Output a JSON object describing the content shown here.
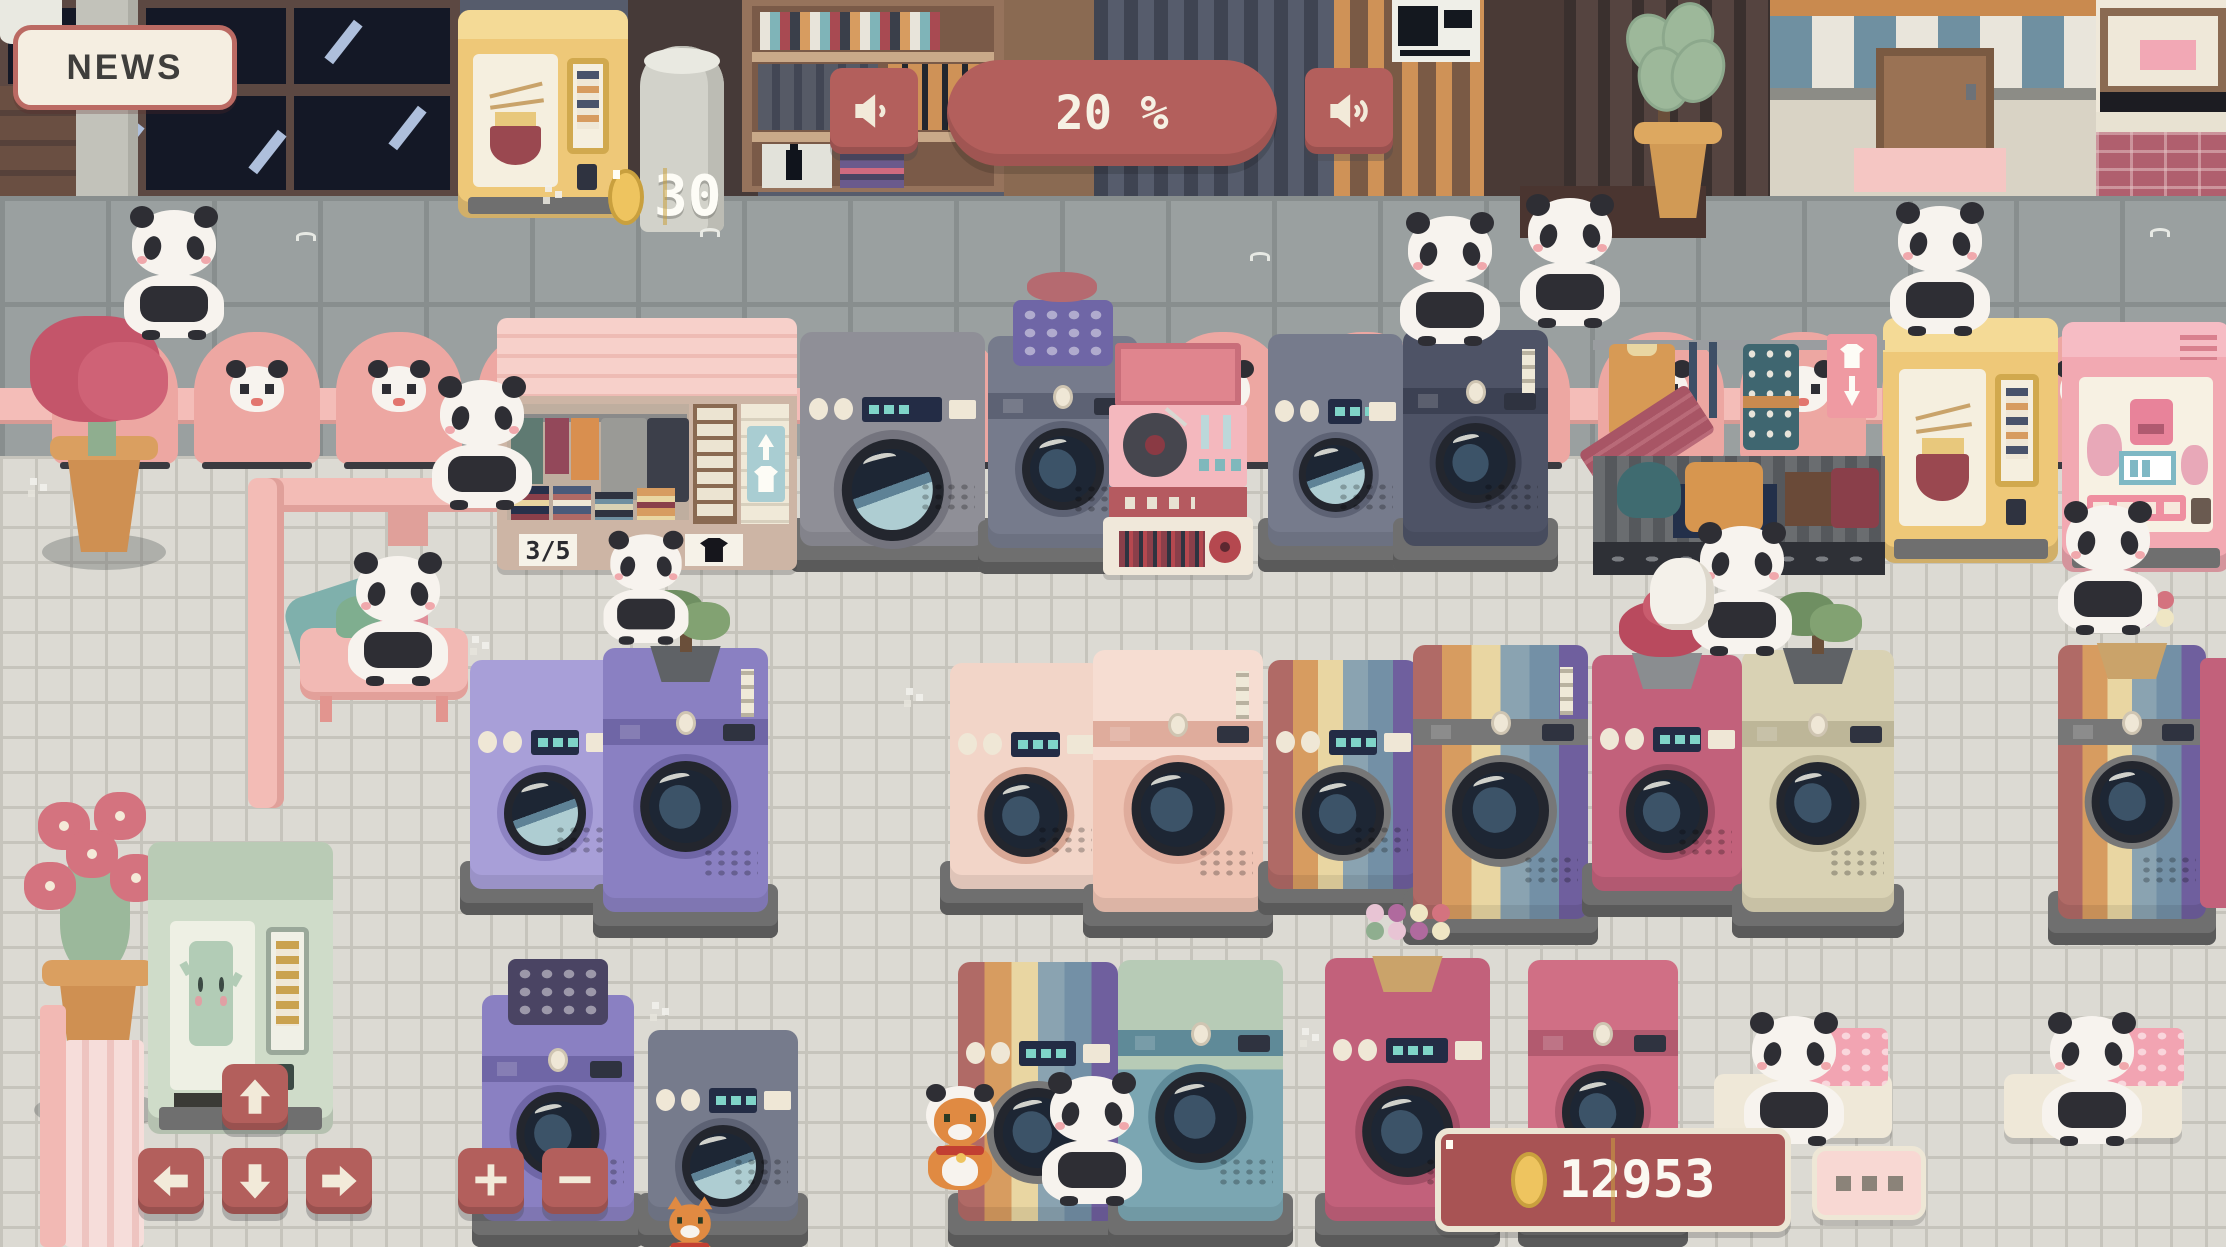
{
  "hud": {
    "news_label": "NEWS",
    "music_volume": "20 %",
    "ramen_stock": "30",
    "stall_capacity": "3/5",
    "coin_balance": "12953"
  },
  "controls": {
    "zoom_in_label": "+",
    "zoom_out_label": "−",
    "pan_up_icon": "arrow-up-icon",
    "pan_down_icon": "arrow-down-icon",
    "pan_left_icon": "arrow-left-icon",
    "pan_right_icon": "arrow-right-icon",
    "volume_left_icon": "speaker-low-icon",
    "volume_right_icon": "speaker-high-icon",
    "more_menu_icon": "ellipsis-icon",
    "coin_icon": "coin-icon",
    "stall_tag_icon": "shirt-icon"
  },
  "colors": {
    "accent_red": "#b35f5c",
    "cream": "#f2ead9",
    "panel_cream": "#f5eee1",
    "text_dark": "#3f3e3c",
    "maroon_panel": "#a85354",
    "pink_button": "#f8d8d3",
    "dot_grey": "#8b8379",
    "coin_gold": "#eec45f",
    "coin_gold_dark": "#c9a03e",
    "pink_chair": "#eda7a2",
    "pink_rail": "#f4bdb8",
    "pavement": "#9aa0a0",
    "pavement_line": "#888e8e",
    "floor": "#dcdad3",
    "floor_line": "#c6c4bc",
    "panda_white": "#f7f3ee",
    "panda_black": "#2e2e34"
  },
  "palettes": {
    "grey": {
      "body": "#8f8f97",
      "accent": "#74747e"
    },
    "slate": {
      "body": "#767b8c",
      "accent": "#5d6274"
    },
    "navy": {
      "body": "#4e5366",
      "accent": "#3c4153"
    },
    "lavender": {
      "body": "#a89fd8",
      "accent": "#8d83c2"
    },
    "purple": {
      "body": "#8a80c2",
      "accent": "#6f66a6"
    },
    "blush": {
      "body": "#f2d5c8",
      "accent": "#d8a896"
    },
    "palepink": {
      "top": "#f6ddd2",
      "body": "#efc4b4",
      "accent": "#dfac9c"
    },
    "rose": {
      "body": "#c2617b",
      "accent": "#a34e66"
    },
    "rose2": {
      "body": "#d06f85",
      "accent": "#b25a6f"
    },
    "sand": {
      "body": "#d9d2b4",
      "accent": "#bdb698"
    },
    "teal": {
      "top": "#b7cbb6",
      "body": "#7ba6b2",
      "accent": "#5f8a98"
    },
    "rainbow": {
      "stripes": [
        "#b06a66",
        "#d79c60",
        "#e9d6a2",
        "#8aa3b1",
        "#7390a6",
        "#6f5f9e"
      ]
    }
  },
  "scene": {
    "chairs": [
      {
        "x": 52,
        "y": 332
      },
      {
        "x": 194,
        "y": 332
      },
      {
        "x": 336,
        "y": 332
      },
      {
        "x": 478,
        "y": 332
      },
      {
        "x": 620,
        "y": 332
      },
      {
        "x": 876,
        "y": 332
      },
      {
        "x": 1018,
        "y": 332
      },
      {
        "x": 1160,
        "y": 332
      },
      {
        "x": 1302,
        "y": 332
      },
      {
        "x": 1444,
        "y": 332
      },
      {
        "x": 1598,
        "y": 332
      },
      {
        "x": 1740,
        "y": 332
      },
      {
        "x": 1882,
        "y": 332
      },
      {
        "x": 2024,
        "y": 332
      },
      {
        "x": 2166,
        "y": 332
      }
    ],
    "machines": [
      {
        "x": 800,
        "y": 332,
        "w": 185,
        "h": 240,
        "p": "grey",
        "t": "front",
        "water": true,
        "z": 12
      },
      {
        "x": 988,
        "y": 336,
        "w": 150,
        "h": 238,
        "p": "slate",
        "t": "top",
        "decor": "basket-purple",
        "z": 12
      },
      {
        "x": 1268,
        "y": 334,
        "w": 135,
        "h": 238,
        "p": "slate",
        "t": "front",
        "water": true,
        "z": 12
      },
      {
        "x": 1403,
        "y": 330,
        "w": 145,
        "h": 242,
        "p": "navy",
        "t": "top",
        "note": true,
        "z": 12
      },
      {
        "x": 470,
        "y": 660,
        "w": 150,
        "h": 255,
        "p": "lavender",
        "t": "front",
        "water": true,
        "z": 20
      },
      {
        "x": 603,
        "y": 648,
        "w": 165,
        "h": 290,
        "p": "purple",
        "t": "top",
        "decor": "bonsai",
        "note": true,
        "z": 20
      },
      {
        "x": 950,
        "y": 663,
        "w": 152,
        "h": 252,
        "p": "blush",
        "t": "front",
        "z": 20
      },
      {
        "x": 1093,
        "y": 650,
        "w": 170,
        "h": 288,
        "p": "palepink",
        "t": "top",
        "note": true,
        "z": 20
      },
      {
        "x": 1268,
        "y": 660,
        "w": 150,
        "h": 255,
        "p": "rainbow",
        "t": "front",
        "z": 20
      },
      {
        "x": 1413,
        "y": 645,
        "w": 175,
        "h": 300,
        "p": "rainbow",
        "t": "top",
        "note": true,
        "z": 20
      },
      {
        "x": 1592,
        "y": 655,
        "w": 150,
        "h": 262,
        "p": "rose",
        "t": "front",
        "decor": "flowers-red",
        "z": 20
      },
      {
        "x": 1742,
        "y": 650,
        "w": 152,
        "h": 288,
        "p": "sand",
        "t": "top",
        "decor": "bonsai",
        "z": 20
      },
      {
        "x": 2058,
        "y": 645,
        "w": 148,
        "h": 300,
        "p": "rainbow",
        "t": "top",
        "decor": "flowers-basket",
        "z": 20
      },
      {
        "x": 482,
        "y": 995,
        "w": 152,
        "h": 252,
        "p": "purple",
        "t": "top",
        "decor": "basket-dots",
        "z": 34
      },
      {
        "x": 648,
        "y": 1030,
        "w": 150,
        "h": 217,
        "p": "slate",
        "t": "front",
        "water": true,
        "z": 34
      },
      {
        "x": 958,
        "y": 962,
        "w": 160,
        "h": 285,
        "p": "rainbow",
        "t": "front",
        "z": 34
      },
      {
        "x": 1118,
        "y": 960,
        "w": 165,
        "h": 287,
        "p": "teal",
        "t": "top",
        "z": 34
      },
      {
        "x": 1325,
        "y": 958,
        "w": 165,
        "h": 289,
        "p": "rose",
        "t": "front",
        "decor": "flowers-basket",
        "z": 34
      },
      {
        "x": 1528,
        "y": 960,
        "w": 150,
        "h": 287,
        "p": "rose2",
        "t": "top",
        "z": 34
      }
    ],
    "pandas": [
      {
        "x": 118,
        "y": 210
      },
      {
        "x": 1394,
        "y": 216,
        "flip": true
      },
      {
        "x": 1514,
        "y": 198
      },
      {
        "x": 1884,
        "y": 206,
        "flip": true
      },
      {
        "x": 426,
        "y": 380
      },
      {
        "x": 590,
        "y": 515,
        "s": 0.85
      },
      {
        "x": 342,
        "y": 556
      },
      {
        "x": 1686,
        "y": 526
      },
      {
        "x": 2052,
        "y": 505,
        "flip": true
      },
      {
        "x": 1036,
        "y": 1076
      },
      {
        "x": 1738,
        "y": 1016
      },
      {
        "x": 2036,
        "y": 1016,
        "flip": true
      }
    ],
    "cats": [
      {
        "x": 918,
        "y": 1086,
        "hood": true
      },
      {
        "x": 648,
        "y": 1174,
        "s": 0.8
      }
    ],
    "plants": [
      {
        "t": "redleaf",
        "x": 26,
        "y": 316
      },
      {
        "t": "pinkflower",
        "x": 20,
        "y": 792
      },
      {
        "t": "ficus",
        "x": 1628,
        "y": 2
      }
    ],
    "vendings": [
      {
        "t": "ramen",
        "x": 458,
        "y": 10,
        "w": 170,
        "h": 208,
        "z": 3
      },
      {
        "t": "ramen",
        "x": 1883,
        "y": 318,
        "w": 175,
        "h": 245,
        "z": 13
      },
      {
        "t": "milk",
        "x": 2062,
        "y": 322,
        "w": 168,
        "h": 250,
        "z": 13
      },
      {
        "t": "water",
        "x": 148,
        "y": 842,
        "w": 185,
        "h": 292,
        "z": 22
      }
    ],
    "props": [
      {
        "t": "steam",
        "x": 0,
        "y": 0,
        "w": 62,
        "h": 44
      },
      {
        "t": "pipeH",
        "x": 248,
        "y": 478,
        "w": 280,
        "h": 34
      },
      {
        "t": "pipeV",
        "x": 248,
        "y": 478,
        "w": 36,
        "h": 330
      },
      {
        "t": "pipeFoot",
        "x": 388,
        "y": 510,
        "w": 40,
        "h": 36
      },
      {
        "t": "pipeV",
        "x": 2206,
        "y": 390,
        "w": 20,
        "h": 84
      },
      {
        "t": "board",
        "x": 292,
        "y": 582,
        "w": 125,
        "h": 96
      },
      {
        "t": "tablePink",
        "x": 300,
        "y": 628,
        "w": 168,
        "h": 72
      },
      {
        "t": "bundle",
        "x": 336,
        "y": 596,
        "w": 92,
        "h": 42
      },
      {
        "t": "bag",
        "x": 1650,
        "y": 558,
        "w": 64,
        "h": 72
      },
      {
        "t": "tableCream",
        "x": 1714,
        "y": 1074,
        "w": 178,
        "h": 64
      },
      {
        "t": "tableCream",
        "x": 2004,
        "y": 1074,
        "w": 178,
        "h": 64
      },
      {
        "t": "basketPink",
        "x": 1796,
        "y": 1028,
        "w": 92,
        "h": 58
      },
      {
        "t": "basketPink",
        "x": 2092,
        "y": 1028,
        "w": 92,
        "h": 58
      },
      {
        "t": "bench",
        "x": 64,
        "y": 1040,
        "w": 80,
        "h": 207
      },
      {
        "t": "curtain",
        "x": 40,
        "y": 1005,
        "w": 26,
        "h": 242
      },
      {
        "t": "sliver",
        "x": 2200,
        "y": 658,
        "w": 26,
        "h": 250
      }
    ],
    "marks": [
      {
        "t": "sq",
        "x": 700,
        "y": 228
      },
      {
        "t": "sq",
        "x": 1250,
        "y": 252
      },
      {
        "t": "sq",
        "x": 2150,
        "y": 228
      },
      {
        "t": "sq",
        "x": 296,
        "y": 232
      },
      {
        "t": "sq",
        "x": 1968,
        "y": 314
      },
      {
        "t": "sp",
        "x": 472,
        "y": 636
      },
      {
        "t": "sp",
        "x": 646,
        "y": 828
      },
      {
        "t": "sp",
        "x": 906,
        "y": 688
      },
      {
        "t": "sp",
        "x": 1192,
        "y": 758
      },
      {
        "t": "sp",
        "x": 1484,
        "y": 700
      },
      {
        "t": "sp",
        "x": 1704,
        "y": 898
      },
      {
        "t": "sp",
        "x": 2142,
        "y": 758
      },
      {
        "t": "sp",
        "x": 652,
        "y": 1002
      },
      {
        "t": "sp",
        "x": 1302,
        "y": 1028
      },
      {
        "t": "sp",
        "x": 872,
        "y": 478
      },
      {
        "t": "sp",
        "x": 30,
        "y": 478
      },
      {
        "t": "sp",
        "x": 545,
        "y": 185
      }
    ]
  }
}
